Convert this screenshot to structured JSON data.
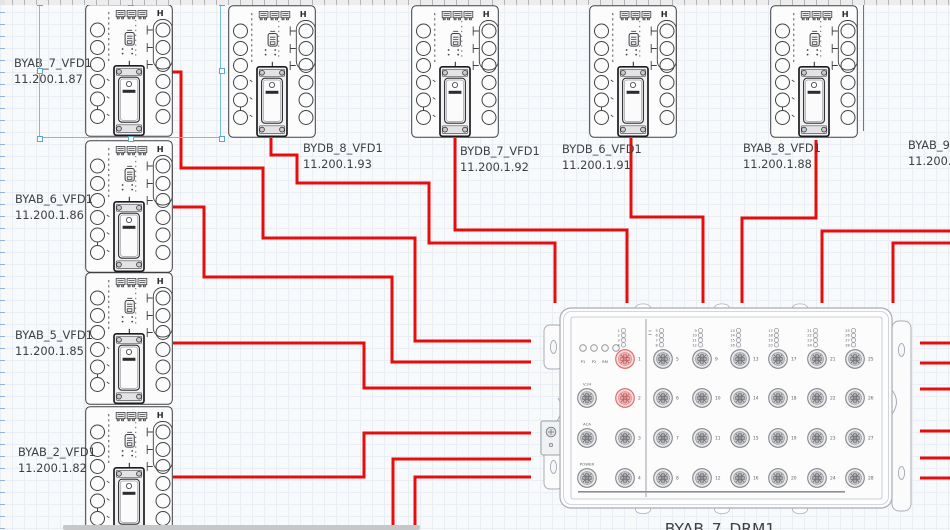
{
  "canvas": {
    "width": 950,
    "height": 530
  },
  "colors": {
    "cable": "#e80d0d",
    "selection": "#7bbde2",
    "device_stroke": "#3f4043",
    "label_text": "#3e3f42",
    "drm_stroke": "#a7adb5",
    "port_gray": "#85878b",
    "port_highlight": "#d96b6b",
    "ruler_tick_blue": "#8fb2d6",
    "scrollbar_thumb": "#c6c7c9"
  },
  "vfd_icon_text": "H",
  "vfd_devices": [
    {
      "name": "BYAB_7_VFD1",
      "ip": "11.200.1.87",
      "x": 85,
      "y": 4,
      "label": {
        "x": 14,
        "y": 55
      },
      "selected": true
    },
    {
      "name": "BYAB_6_VFD1",
      "ip": "11.200.1.86",
      "x": 85,
      "y": 140,
      "label": {
        "x": 15,
        "y": 191
      },
      "selected": false
    },
    {
      "name": "BYAB_5_VFD1",
      "ip": "11.200.1.85",
      "x": 85,
      "y": 272,
      "label": {
        "x": 15,
        "y": 327
      },
      "selected": false
    },
    {
      "name": "BYAB_2_VFD1",
      "ip": "11.200.1.82",
      "x": 85,
      "y": 406,
      "label": {
        "x": 18,
        "y": 444
      },
      "selected": false
    },
    {
      "name": "BYDB_8_VFD1",
      "ip": "11.200.1.93",
      "x": 228,
      "y": 5,
      "label": {
        "x": 303,
        "y": 140
      },
      "selected": false
    },
    {
      "name": "BYDB_7_VFD1",
      "ip": "11.200.1.92",
      "x": 411,
      "y": 5,
      "label": {
        "x": 460,
        "y": 143
      },
      "selected": false
    },
    {
      "name": "BYDB_6_VFD1",
      "ip": "11.200.1.91",
      "x": 589,
      "y": 5,
      "label": {
        "x": 562,
        "y": 141
      },
      "selected": false
    },
    {
      "name": "BYAB_8_VFD1",
      "ip": "11.200.1.88",
      "x": 770,
      "y": 5,
      "label": {
        "x": 743,
        "y": 140
      },
      "selected": false
    }
  ],
  "partial_device": {
    "name": "BYAB_9_",
    "ip": "11.200.1",
    "label_x": 908,
    "label_y": 137
  },
  "edge_line": {
    "x": 863,
    "y1": 5,
    "y2": 131
  },
  "selection": {
    "x": 39,
    "y": 2,
    "width": 182,
    "height": 136
  },
  "drm": {
    "name": "BYAB_7_DRM1",
    "x": 560,
    "y": 305,
    "status_leds": [
      "P1",
      "P2",
      "RM",
      "FAULT"
    ],
    "side_ports": [
      "V.24",
      "ACA",
      "POWER"
    ],
    "port_columns": [
      [
        1,
        2,
        3,
        4
      ],
      [
        5,
        6,
        7,
        8
      ],
      [
        9,
        10,
        11,
        12
      ],
      [
        13,
        14,
        15,
        16
      ],
      [
        17,
        18,
        19,
        20
      ],
      [
        21,
        22,
        23,
        24
      ],
      [
        25,
        26,
        27,
        28
      ]
    ],
    "highlighted_ports": [
      1,
      2
    ],
    "label_x": 645,
    "label_y": 520
  },
  "cables": [
    {
      "from": "BYAB_7_VFD1",
      "points": [
        [
          172,
          72
        ],
        [
          181,
          72
        ],
        [
          181,
          168
        ],
        [
          263,
          168
        ],
        [
          263,
          238
        ],
        [
          415,
          238
        ],
        [
          415,
          341
        ],
        [
          531,
          341
        ]
      ]
    },
    {
      "from": "BYAB_6_VFD1",
      "points": [
        [
          173,
          207
        ],
        [
          204,
          207
        ],
        [
          204,
          277
        ],
        [
          392,
          277
        ],
        [
          392,
          362
        ],
        [
          531,
          362
        ]
      ]
    },
    {
      "from": "BYAB_5_VFD1",
      "points": [
        [
          173,
          343
        ],
        [
          364,
          343
        ],
        [
          364,
          388
        ],
        [
          531,
          388
        ]
      ]
    },
    {
      "from": "BYAB_2_VFD1",
      "points": [
        [
          173,
          477
        ],
        [
          364,
          477
        ],
        [
          364,
          433
        ],
        [
          531,
          433
        ]
      ]
    },
    {
      "from": "offscreen-bottom",
      "points": [
        [
          393,
          532
        ],
        [
          393,
          459
        ],
        [
          531,
          459
        ]
      ]
    },
    {
      "from": "offscreen-bottom",
      "points": [
        [
          415,
          532
        ],
        [
          415,
          477
        ],
        [
          531,
          477
        ]
      ]
    },
    {
      "from": "BYDB_8_VFD1",
      "points": [
        [
          271,
          138
        ],
        [
          271,
          155
        ],
        [
          297,
          155
        ],
        [
          297,
          183
        ],
        [
          429,
          183
        ],
        [
          429,
          243
        ],
        [
          555,
          243
        ],
        [
          555,
          303
        ]
      ]
    },
    {
      "from": "BYDB_7_VFD1",
      "points": [
        [
          455,
          138
        ],
        [
          455,
          230
        ],
        [
          627,
          230
        ],
        [
          627,
          303
        ]
      ]
    },
    {
      "from": "BYDB_6_VFD1",
      "points": [
        [
          631,
          138
        ],
        [
          631,
          217
        ],
        [
          703,
          217
        ],
        [
          703,
          303
        ]
      ]
    },
    {
      "from": "BYAB_8_VFD1",
      "points": [
        [
          816,
          140
        ],
        [
          816,
          218
        ],
        [
          742,
          218
        ],
        [
          742,
          303
        ]
      ]
    },
    {
      "from": "offscreen-right",
      "points": [
        [
          951,
          231
        ],
        [
          822,
          231
        ],
        [
          822,
          303
        ]
      ]
    },
    {
      "from": "offscreen-right",
      "points": [
        [
          951,
          243
        ],
        [
          893,
          243
        ],
        [
          893,
          303
        ]
      ]
    },
    {
      "from": "offscreen-right",
      "points": [
        [
          920,
          343
        ],
        [
          951,
          343
        ]
      ]
    },
    {
      "from": "offscreen-right",
      "points": [
        [
          920,
          363
        ],
        [
          951,
          363
        ]
      ]
    },
    {
      "from": "offscreen-right",
      "points": [
        [
          920,
          389
        ],
        [
          951,
          389
        ]
      ]
    },
    {
      "from": "offscreen-right",
      "points": [
        [
          920,
          431
        ],
        [
          951,
          431
        ]
      ]
    },
    {
      "from": "offscreen-right",
      "points": [
        [
          920,
          458
        ],
        [
          951,
          458
        ]
      ]
    },
    {
      "from": "offscreen-right",
      "points": [
        [
          920,
          478
        ],
        [
          951,
          478
        ]
      ]
    }
  ],
  "scrollbar": {
    "x": 63,
    "y": 525,
    "width": 357,
    "height": 5
  }
}
